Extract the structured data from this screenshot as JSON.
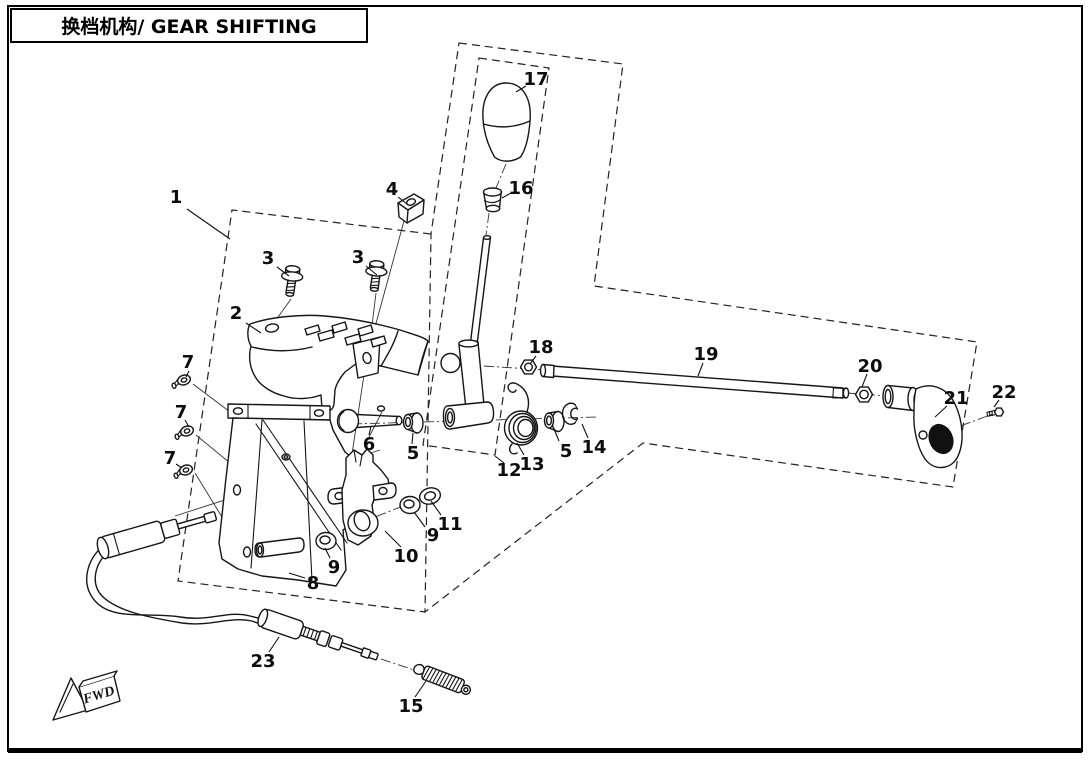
{
  "page": {
    "title": "换档机构/ GEAR SHIFTING"
  },
  "fwd_marker": {
    "label": "FWD"
  },
  "diagram": {
    "callouts": [
      {
        "n": "1",
        "x": 176,
        "y": 197,
        "l": [
          187,
          209,
          230,
          239
        ]
      },
      {
        "n": "2",
        "x": 236,
        "y": 313,
        "l": [
          246,
          323,
          261,
          333
        ]
      },
      {
        "n": "3",
        "x": 268,
        "y": 258,
        "l": [
          277,
          267,
          289,
          276
        ]
      },
      {
        "n": "3",
        "x": 358,
        "y": 257,
        "l": [
          366,
          266,
          377,
          275
        ]
      },
      {
        "n": "4",
        "x": 392,
        "y": 189,
        "l": [
          398,
          197,
          407,
          204
        ]
      },
      {
        "n": "7",
        "x": 188,
        "y": 362,
        "l": [
          189,
          371,
          186,
          377
        ]
      },
      {
        "n": "7",
        "x": 181,
        "y": 412,
        "l": [
          185,
          420,
          189,
          427
        ]
      },
      {
        "n": "7",
        "x": 170,
        "y": 458,
        "l": [
          176,
          464,
          182,
          468
        ]
      },
      {
        "n": "6",
        "x": 369,
        "y": 444,
        "l": [
          369,
          435,
          371,
          426
        ]
      },
      {
        "n": "5",
        "x": 413,
        "y": 453,
        "l": [
          412,
          444,
          413,
          433
        ]
      },
      {
        "n": "12",
        "x": 509,
        "y": 470,
        "l": [
          504,
          463,
          495,
          456
        ]
      },
      {
        "n": "13",
        "x": 532,
        "y": 464,
        "l": [
          524,
          455,
          517,
          443
        ]
      },
      {
        "n": "5",
        "x": 566,
        "y": 451,
        "l": [
          559,
          441,
          554,
          429
        ]
      },
      {
        "n": "14",
        "x": 594,
        "y": 447,
        "l": [
          588,
          438,
          582,
          424
        ]
      },
      {
        "n": "18",
        "x": 541,
        "y": 347,
        "l": [
          536,
          356,
          530,
          364
        ]
      },
      {
        "n": "19",
        "x": 706,
        "y": 354,
        "l": [
          703,
          363,
          698,
          376
        ]
      },
      {
        "n": "20",
        "x": 870,
        "y": 366,
        "l": [
          867,
          374,
          862,
          387
        ]
      },
      {
        "n": "21",
        "x": 956,
        "y": 398,
        "l": [
          947,
          406,
          935,
          417
        ]
      },
      {
        "n": "22",
        "x": 1004,
        "y": 392,
        "l": [
          999,
          400,
          994,
          407
        ]
      },
      {
        "n": "16",
        "x": 521,
        "y": 188,
        "l": [
          511,
          193,
          502,
          198
        ]
      },
      {
        "n": "17",
        "x": 536,
        "y": 79,
        "l": [
          526,
          86,
          516,
          92
        ]
      },
      {
        "n": "8",
        "x": 313,
        "y": 583,
        "l": [
          305,
          578,
          289,
          573
        ]
      },
      {
        "n": "9",
        "x": 334,
        "y": 567,
        "l": [
          330,
          558,
          325,
          548
        ]
      },
      {
        "n": "10",
        "x": 406,
        "y": 556,
        "l": [
          401,
          547,
          385,
          531
        ]
      },
      {
        "n": "9",
        "x": 433,
        "y": 535,
        "l": [
          425,
          527,
          414,
          512
        ]
      },
      {
        "n": "11",
        "x": 450,
        "y": 524,
        "l": [
          441,
          515,
          431,
          501
        ]
      },
      {
        "n": "15",
        "x": 411,
        "y": 706,
        "l": [
          415,
          697,
          426,
          681
        ]
      },
      {
        "n": "23",
        "x": 263,
        "y": 661,
        "l": [
          269,
          652,
          279,
          637
        ]
      }
    ]
  }
}
